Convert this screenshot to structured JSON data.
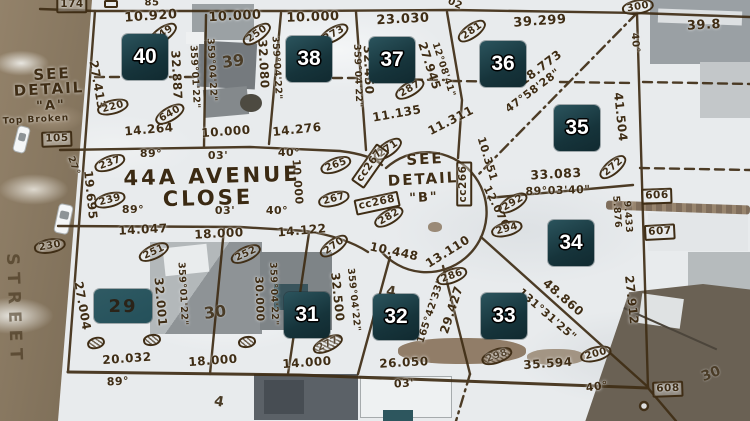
{
  "title": "Aerial survey plat overlay — 44A Avenue Close cul-de-sac, lots 29-40",
  "map": {
    "street": {
      "line1": "44A AVENUE",
      "line2": "CLOSE",
      "vertical": "STREET"
    },
    "detail_a": {
      "l1": "SEE",
      "l2": "DETAIL",
      "l3": "\"A\"",
      "l4": "Top Broken"
    },
    "detail_b": {
      "l1": "SEE",
      "l2": "DETAIL",
      "l3": "\"B\""
    },
    "colors": {
      "plat_ink": "#3f2d15",
      "badge_bg": "#16343b",
      "badge_patch": "#2a535c",
      "badge_text": "#ffffff",
      "snow": "#e8ebed",
      "road": "#8a795f",
      "teal_patch": "#2d565e"
    },
    "lot_badges": [
      {
        "lot": "40",
        "x": 145,
        "y": 57
      },
      {
        "lot": "38",
        "x": 309,
        "y": 59
      },
      {
        "lot": "37",
        "x": 392,
        "y": 60
      },
      {
        "lot": "36",
        "x": 503,
        "y": 64
      },
      {
        "lot": "35",
        "x": 577,
        "y": 128
      },
      {
        "lot": "34",
        "x": 571,
        "y": 243
      },
      {
        "lot": "33",
        "x": 504,
        "y": 316
      },
      {
        "lot": "32",
        "x": 396,
        "y": 317
      },
      {
        "lot": "31",
        "x": 307,
        "y": 315
      },
      {
        "lot": "29",
        "x": 123,
        "y": 306,
        "variant": "dark"
      }
    ],
    "ground_numbers": [
      {
        "t": "39",
        "x": 233,
        "y": 61,
        "r": -8,
        "s": 16
      },
      {
        "t": "30",
        "x": 215,
        "y": 312,
        "r": -8,
        "s": 16
      },
      {
        "t": "30",
        "x": 711,
        "y": 374,
        "r": -22,
        "s": 14
      },
      {
        "t": "4",
        "x": 391,
        "y": 292,
        "r": 8,
        "s": 14
      },
      {
        "t": "4",
        "x": 219,
        "y": 402,
        "r": 10,
        "s": 14
      }
    ],
    "dimensions": [
      {
        "t": "85",
        "x": 152,
        "y": 3,
        "r": 0,
        "s": 10
      },
      {
        "t": "10.920",
        "x": 151,
        "y": 17,
        "r": -4,
        "s": 13
      },
      {
        "t": "10.000",
        "x": 235,
        "y": 17,
        "r": -3,
        "s": 13
      },
      {
        "t": "10.000",
        "x": 313,
        "y": 18,
        "r": -2,
        "s": 13
      },
      {
        "t": "23.030",
        "x": 403,
        "y": 20,
        "r": -3,
        "s": 13
      },
      {
        "t": "02",
        "x": 455,
        "y": 4,
        "r": 25,
        "s": 10
      },
      {
        "t": "39.299",
        "x": 540,
        "y": 22,
        "r": -4,
        "s": 13
      },
      {
        "t": "39.8",
        "x": 704,
        "y": 26,
        "r": -3,
        "s": 13
      },
      {
        "t": "40°",
        "x": 635,
        "y": 43,
        "r": 85,
        "s": 10
      },
      {
        "t": "18.773",
        "x": 541,
        "y": 68,
        "r": -37,
        "s": 12
      },
      {
        "t": "47°58'28\"",
        "x": 533,
        "y": 91,
        "r": -37,
        "s": 11
      },
      {
        "t": "41.504",
        "x": 620,
        "y": 117,
        "r": 84,
        "s": 12
      },
      {
        "t": "27.413",
        "x": 97,
        "y": 85,
        "r": 80,
        "s": 12
      },
      {
        "t": "32.887",
        "x": 176,
        "y": 75,
        "r": 87,
        "s": 12
      },
      {
        "t": "359°01'22\"",
        "x": 194,
        "y": 77,
        "r": 87,
        "s": 9.5
      },
      {
        "t": "359°04'22\"",
        "x": 211,
        "y": 70,
        "r": 87,
        "s": 9.5
      },
      {
        "t": "32.080",
        "x": 263,
        "y": 64,
        "r": 87,
        "s": 12
      },
      {
        "t": "359°04'22\"",
        "x": 276,
        "y": 68,
        "r": 87,
        "s": 9.5
      },
      {
        "t": "359°04'22\"",
        "x": 357,
        "y": 76,
        "r": 88,
        "s": 9.5
      },
      {
        "t": "32.450",
        "x": 368,
        "y": 70,
        "r": 88,
        "s": 12
      },
      {
        "t": "27.945",
        "x": 429,
        "y": 66,
        "r": 72,
        "s": 12
      },
      {
        "t": "12°08'41\"",
        "x": 443,
        "y": 70,
        "r": 72,
        "s": 9.5
      },
      {
        "t": "11.135",
        "x": 397,
        "y": 114,
        "r": -10,
        "s": 12
      },
      {
        "t": "11.311",
        "x": 451,
        "y": 121,
        "r": -27,
        "s": 12
      },
      {
        "t": "14.264",
        "x": 149,
        "y": 130,
        "r": -5,
        "s": 12
      },
      {
        "t": "10.000",
        "x": 226,
        "y": 132,
        "r": -4,
        "s": 12
      },
      {
        "t": "14.276",
        "x": 297,
        "y": 130,
        "r": -6,
        "s": 12
      },
      {
        "t": "89°",
        "x": 151,
        "y": 154,
        "r": 0,
        "s": 11
      },
      {
        "t": "03'",
        "x": 218,
        "y": 156,
        "r": 0,
        "s": 11
      },
      {
        "t": "40°",
        "x": 289,
        "y": 153,
        "r": 0,
        "s": 11
      },
      {
        "t": "89°",
        "x": 133,
        "y": 210,
        "r": 0,
        "s": 11
      },
      {
        "t": "03'",
        "x": 225,
        "y": 211,
        "r": 0,
        "s": 11
      },
      {
        "t": "40°",
        "x": 277,
        "y": 211,
        "r": 0,
        "s": 11
      },
      {
        "t": "27°",
        "x": 73,
        "y": 166,
        "r": 70,
        "s": 9.5
      },
      {
        "t": "19.695",
        "x": 90,
        "y": 195,
        "r": 84,
        "s": 12
      },
      {
        "t": "10.000",
        "x": 297,
        "y": 182,
        "r": 86,
        "s": 11
      },
      {
        "t": "10.351",
        "x": 487,
        "y": 159,
        "r": 73,
        "s": 11
      },
      {
        "t": "12.076",
        "x": 496,
        "y": 207,
        "r": 64,
        "s": 11
      },
      {
        "t": "33.083",
        "x": 556,
        "y": 174,
        "r": -3,
        "s": 12.5
      },
      {
        "t": "89°03'40\"",
        "x": 558,
        "y": 191,
        "r": -2,
        "s": 11
      },
      {
        "t": "5.876",
        "x": 616,
        "y": 212,
        "r": 86,
        "s": 9.5
      },
      {
        "t": "9.433",
        "x": 627,
        "y": 217,
        "r": 86,
        "s": 9.5
      },
      {
        "t": "10.448",
        "x": 394,
        "y": 252,
        "r": 12,
        "s": 12
      },
      {
        "t": "13.110",
        "x": 448,
        "y": 252,
        "r": -32,
        "s": 12
      },
      {
        "t": "14.047",
        "x": 143,
        "y": 230,
        "r": -3,
        "s": 12
      },
      {
        "t": "18.000",
        "x": 219,
        "y": 234,
        "r": -3,
        "s": 12
      },
      {
        "t": "14.122",
        "x": 302,
        "y": 231,
        "r": -5,
        "s": 12
      },
      {
        "t": "27.004",
        "x": 82,
        "y": 306,
        "r": 80,
        "s": 12
      },
      {
        "t": "32.001",
        "x": 160,
        "y": 302,
        "r": 85,
        "s": 12
      },
      {
        "t": "359°01'22\"",
        "x": 182,
        "y": 294,
        "r": 87,
        "s": 9.5
      },
      {
        "t": "30.000",
        "x": 259,
        "y": 299,
        "r": 88,
        "s": 11
      },
      {
        "t": "359°04'22\"",
        "x": 273,
        "y": 294,
        "r": 88,
        "s": 9.5
      },
      {
        "t": "32.500",
        "x": 337,
        "y": 297,
        "r": 84,
        "s": 12
      },
      {
        "t": "359°04'22\"",
        "x": 353,
        "y": 300,
        "r": 84,
        "s": 9.5
      },
      {
        "t": "165°42'33\"",
        "x": 431,
        "y": 311,
        "r": -72,
        "s": 10
      },
      {
        "t": "29.427",
        "x": 452,
        "y": 310,
        "r": -72,
        "s": 12
      },
      {
        "t": "48.860",
        "x": 563,
        "y": 298,
        "r": 41,
        "s": 12
      },
      {
        "t": "131°31'25\"",
        "x": 547,
        "y": 315,
        "r": 41,
        "s": 11
      },
      {
        "t": "27.912",
        "x": 631,
        "y": 300,
        "r": 84,
        "s": 12
      },
      {
        "t": "20.032",
        "x": 127,
        "y": 359,
        "r": -4,
        "s": 12
      },
      {
        "t": "89°",
        "x": 118,
        "y": 382,
        "r": -3,
        "s": 11
      },
      {
        "t": "18.000",
        "x": 213,
        "y": 361,
        "r": -4,
        "s": 12
      },
      {
        "t": "14.000",
        "x": 307,
        "y": 363,
        "r": -4,
        "s": 12
      },
      {
        "t": "26.050",
        "x": 404,
        "y": 363,
        "r": -3,
        "s": 12
      },
      {
        "t": "03'",
        "x": 404,
        "y": 384,
        "r": -3,
        "s": 11
      },
      {
        "t": "35.594",
        "x": 548,
        "y": 364,
        "r": -4,
        "s": 12
      },
      {
        "t": "40°",
        "x": 597,
        "y": 387,
        "r": -8,
        "s": 11
      }
    ],
    "monuments": {
      "circled": [
        {
          "t": "649",
          "x": 163,
          "y": 34,
          "r": -35
        },
        {
          "t": "250",
          "x": 257,
          "y": 34,
          "r": -35
        },
        {
          "t": "273",
          "x": 334,
          "y": 34,
          "r": -30
        },
        {
          "t": "281",
          "x": 472,
          "y": 31,
          "r": -35
        },
        {
          "t": "300",
          "x": 638,
          "y": 7,
          "r": -10
        },
        {
          "t": "287",
          "x": 410,
          "y": 89,
          "r": -30
        },
        {
          "t": "220",
          "x": 113,
          "y": 107,
          "r": -15
        },
        {
          "t": "640",
          "x": 170,
          "y": 114,
          "r": -30
        },
        {
          "t": "237",
          "x": 110,
          "y": 163,
          "r": -20
        },
        {
          "t": "239",
          "x": 110,
          "y": 200,
          "r": -15
        },
        {
          "t": "230",
          "x": 50,
          "y": 246,
          "r": -10
        },
        {
          "t": "265",
          "x": 336,
          "y": 165,
          "r": -20
        },
        {
          "t": "267",
          "x": 334,
          "y": 199,
          "r": -15
        },
        {
          "t": "271",
          "x": 388,
          "y": 149,
          "r": -35
        },
        {
          "t": "282",
          "x": 389,
          "y": 217,
          "r": -30
        },
        {
          "t": "292",
          "x": 513,
          "y": 203,
          "r": -30
        },
        {
          "t": "294",
          "x": 507,
          "y": 229,
          "r": -15
        },
        {
          "t": "272",
          "x": 613,
          "y": 167,
          "r": -40
        },
        {
          "t": "251",
          "x": 154,
          "y": 252,
          "r": -25
        },
        {
          "t": "252",
          "x": 246,
          "y": 254,
          "r": -25
        },
        {
          "t": "270",
          "x": 334,
          "y": 246,
          "r": -35
        },
        {
          "t": "286",
          "x": 452,
          "y": 276,
          "r": -20
        },
        {
          "t": "277",
          "x": 328,
          "y": 344,
          "r": -25,
          "scribbled": true
        },
        {
          "t": "298",
          "x": 497,
          "y": 356,
          "r": -20,
          "scribbled": true
        },
        {
          "t": "200",
          "x": 596,
          "y": 354,
          "r": -15
        },
        {
          "t": "",
          "x": 96,
          "y": 343,
          "r": -15,
          "scribbled": true
        },
        {
          "t": "",
          "x": 152,
          "y": 340,
          "r": -10,
          "scribbled": true
        },
        {
          "t": "",
          "x": 247,
          "y": 342,
          "r": -10,
          "scribbled": true
        }
      ],
      "boxed": [
        {
          "t": "174",
          "x": 72,
          "y": 5,
          "r": 0
        },
        {
          "t": "",
          "x": 111,
          "y": 4,
          "r": 0
        },
        {
          "t": "105",
          "x": 57,
          "y": 139,
          "r": -2
        },
        {
          "t": "606",
          "x": 657,
          "y": 196,
          "r": -2
        },
        {
          "t": "607",
          "x": 660,
          "y": 232,
          "r": -3
        },
        {
          "t": "608",
          "x": 668,
          "y": 389,
          "r": -2
        },
        {
          "t": "cc267",
          "x": 370,
          "y": 166,
          "r": -55
        },
        {
          "t": "cc268",
          "x": 377,
          "y": 203,
          "r": -12
        },
        {
          "t": "cc266",
          "x": 464,
          "y": 184,
          "r": -90
        }
      ]
    }
  }
}
